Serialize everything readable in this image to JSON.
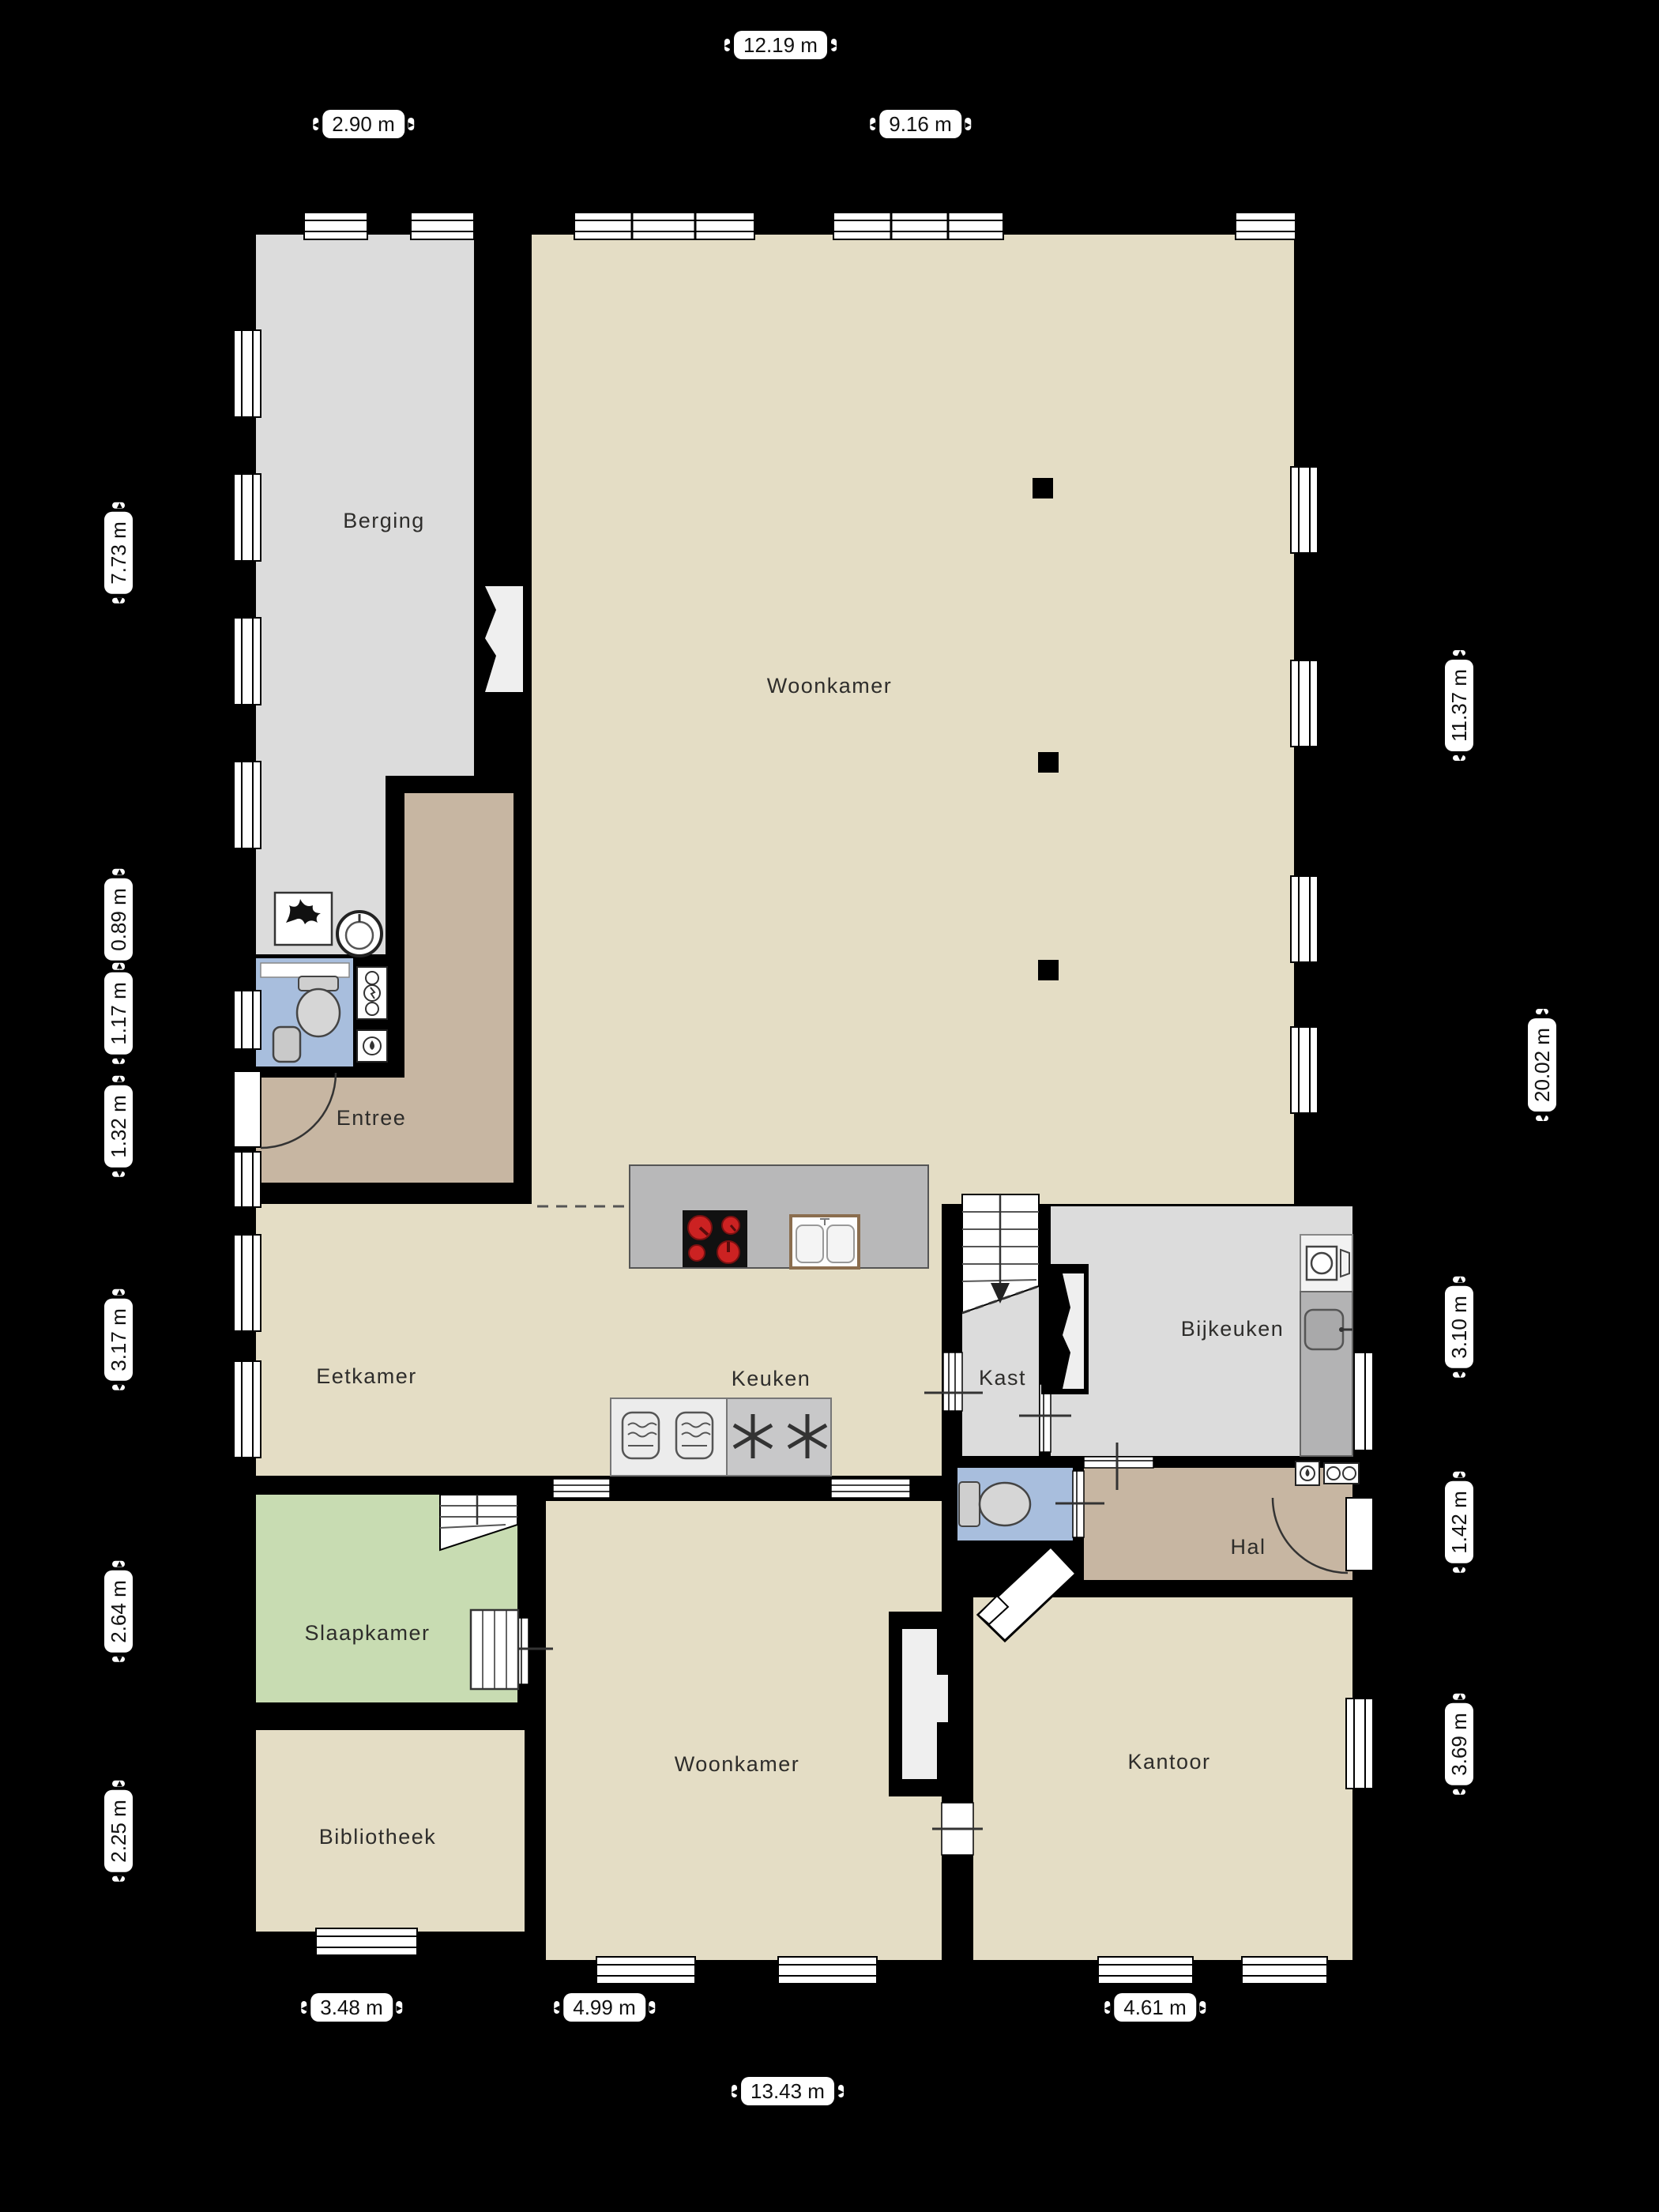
{
  "plan_type": "floorplan-ground-floor",
  "rooms": {
    "berging": {
      "label": "Berging"
    },
    "woonkamer_boven": {
      "label": "Woonkamer"
    },
    "entree": {
      "label": "Entree"
    },
    "eetkamer": {
      "label": "Eetkamer"
    },
    "keuken": {
      "label": "Keuken"
    },
    "kast": {
      "label": "Kast"
    },
    "bijkeuken": {
      "label": "Bijkeuken"
    },
    "slaapkamer": {
      "label": "Slaapkamer"
    },
    "hal": {
      "label": "Hal"
    },
    "woonkamer_beneden": {
      "label": "Woonkamer"
    },
    "bibliotheek": {
      "label": "Bibliotheek"
    },
    "kantoor": {
      "label": "Kantoor"
    }
  },
  "dimensions": {
    "top_total": "12.19 m",
    "top_left": "2.90 m",
    "top_right": "9.16 m",
    "left_1": "7.73 m",
    "left_2": "0.89 m",
    "left_3": "1.17 m",
    "left_4": "1.32 m",
    "left_5": "3.17 m",
    "left_6": "2.64 m",
    "left_7": "2.25 m",
    "right_1": "11.37 m",
    "right_total": "20.02 m",
    "right_2": "3.10 m",
    "right_3": "1.42 m",
    "right_4": "3.69 m",
    "bottom_1": "3.48 m",
    "bottom_2": "4.99 m",
    "bottom_3": "4.61 m",
    "bottom_total": "13.43 m"
  },
  "colors": {
    "background": "#000000",
    "floor_beige": "#e4ddc5",
    "floor_gray": "#dcdcdc",
    "floor_tan": "#c7b6a2",
    "floor_blue": "#a8bedd",
    "floor_green": "#c8dcb2",
    "counter_gray": "#b8b8b9",
    "counter_dark": "#b3b3b4",
    "appliance_light": "#ececec",
    "appliance_dark": "#c8c8c9",
    "burner_red": "#cc2222"
  },
  "icons": {
    "stove": "4-burner-hob-icon",
    "double_sink": "double-basin-sink-icon",
    "single_sink": "single-basin-sink-icon",
    "round_basin": "round-washbasin-icon",
    "toilet": "toilet-icon",
    "washbasin": "washbasin-icon",
    "washing_machine": "washing-machine-icon",
    "fireplace": "fireplace-flame-icon",
    "stairs": "staircase-icon",
    "oven": "oven-icon",
    "freezer": "snowflake-star-icon",
    "meter": "utility-meter-icon",
    "water_meter": "water-drop-meter-icon"
  }
}
